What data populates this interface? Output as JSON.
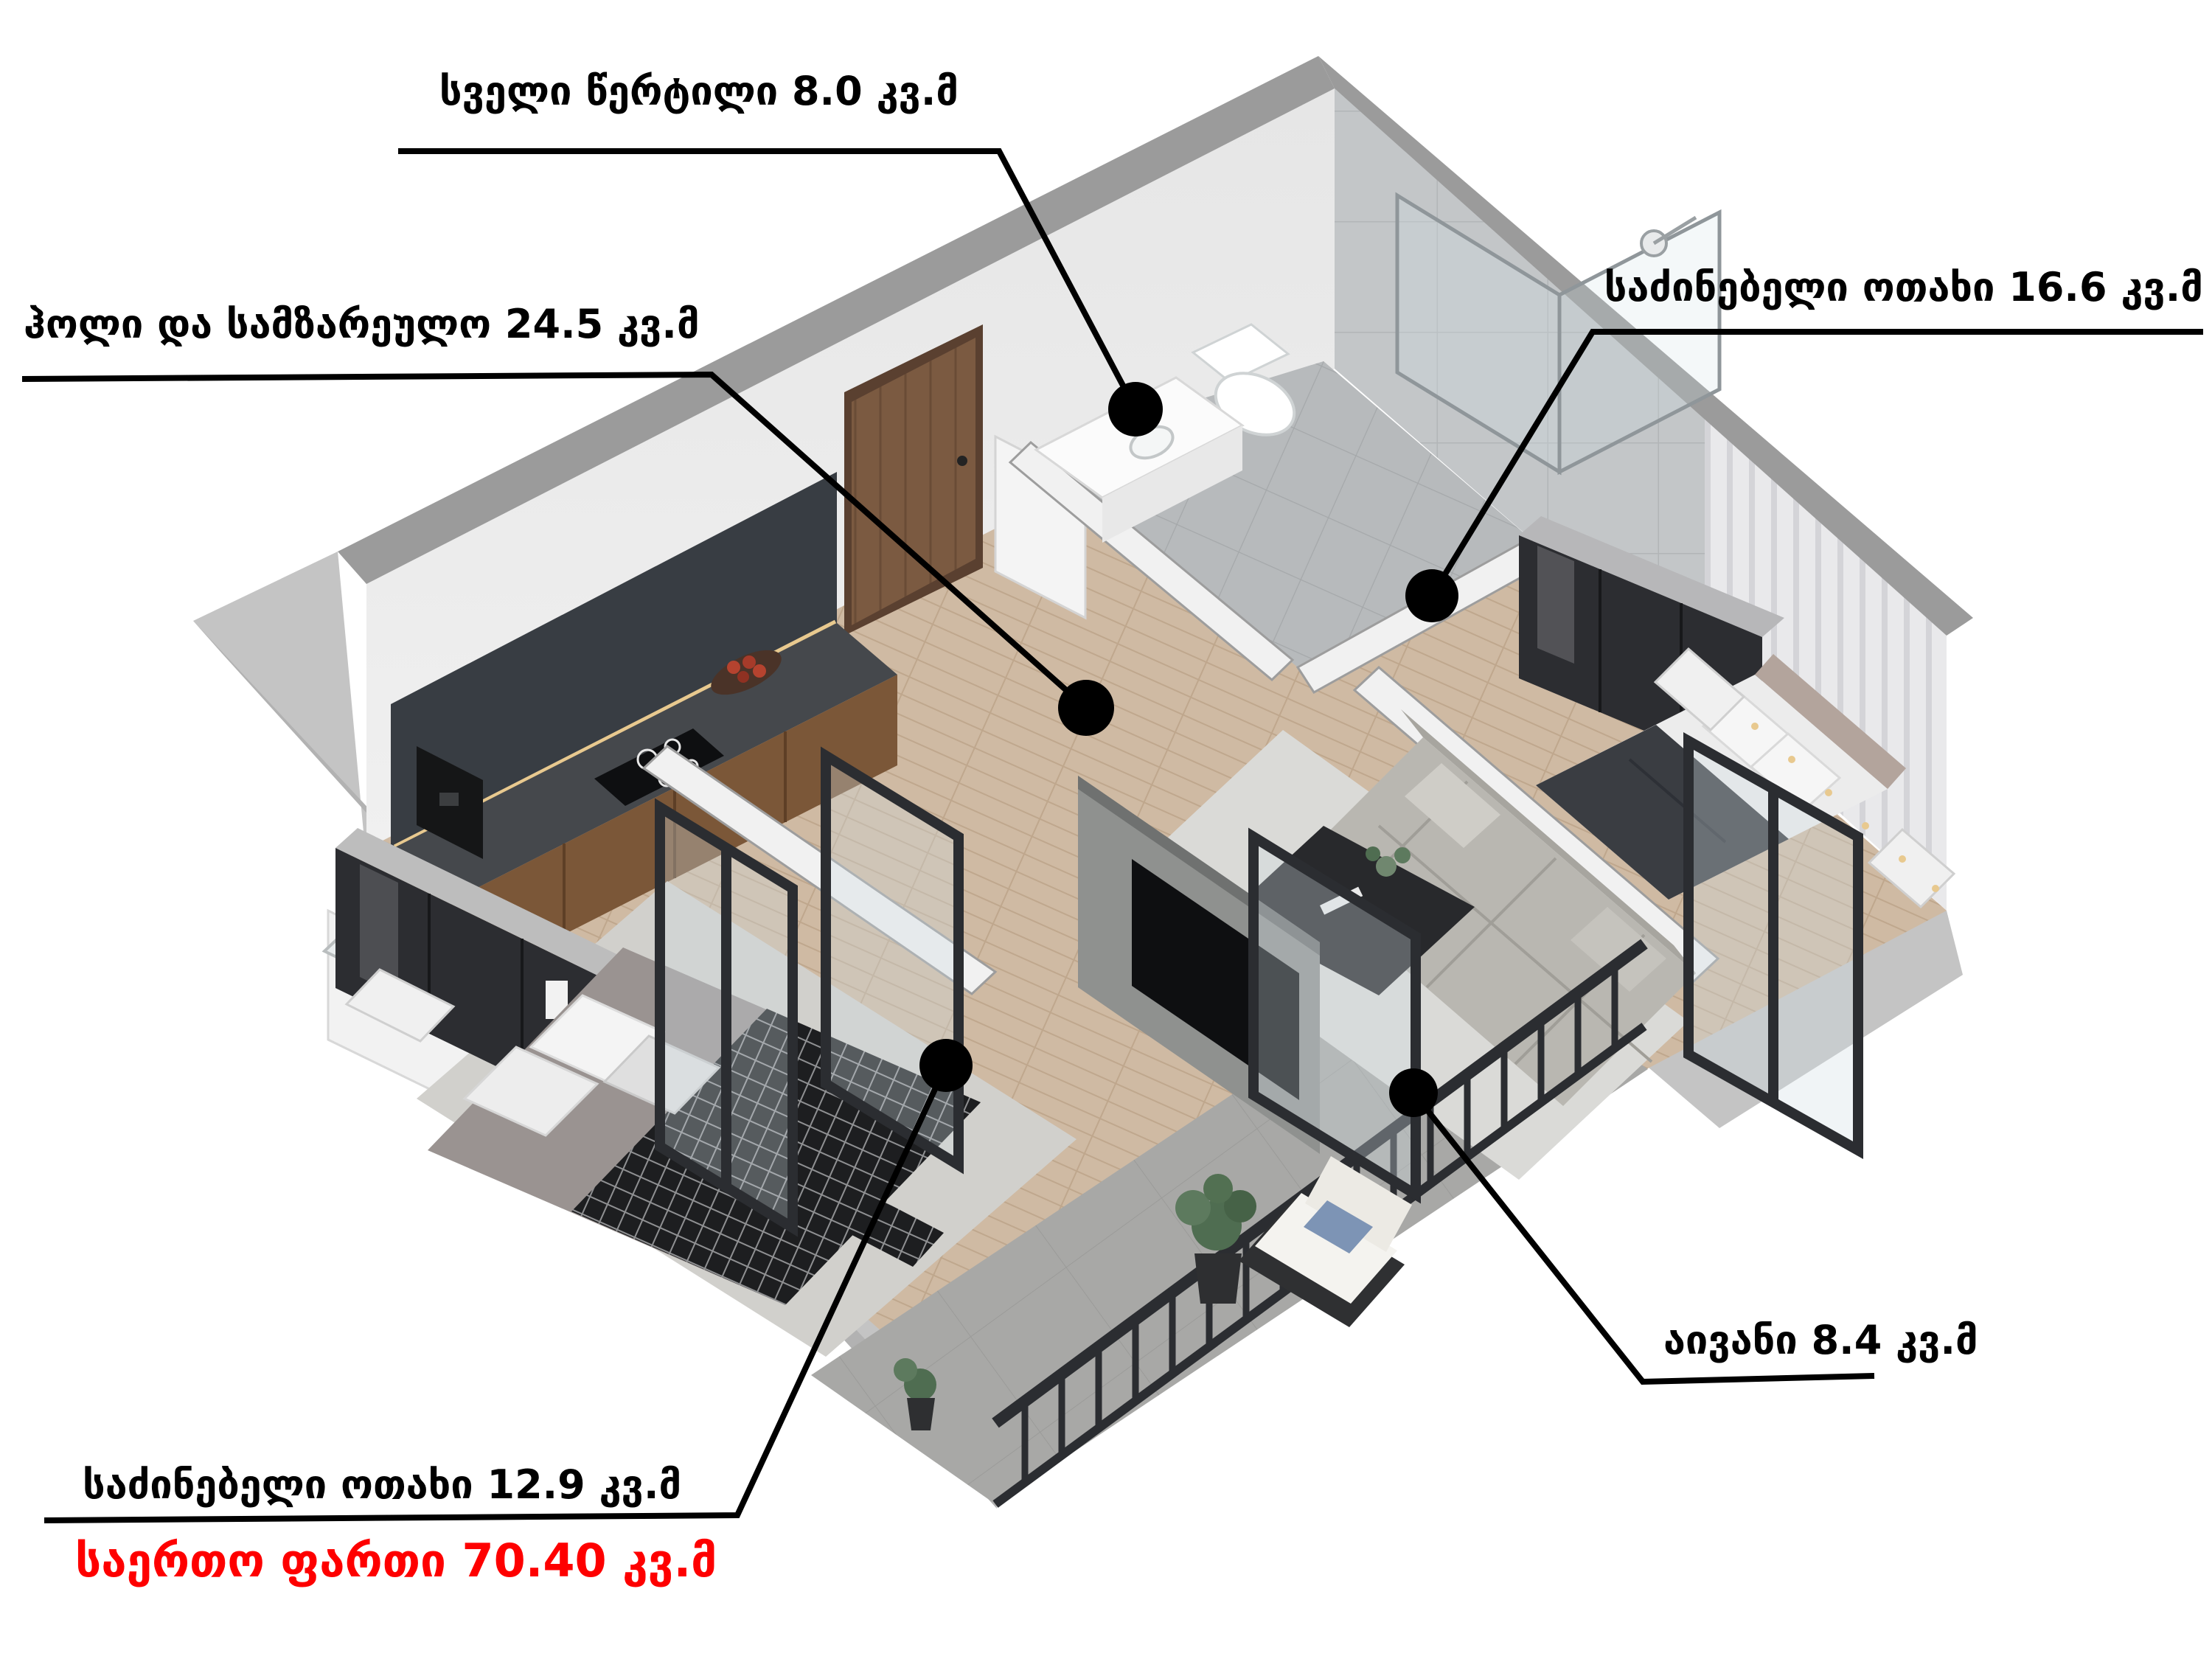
{
  "page": {
    "type": "3d-floor-plan-render",
    "background": "#ffffff",
    "language": "Georgian"
  },
  "units_label": "კვ.მ",
  "rooms": [
    {
      "id": "wet-point",
      "name": "სველი წერტილი",
      "area_sqm": 8.0,
      "label": "სველი წერტილი 8.0 კვ.მ"
    },
    {
      "id": "hall-kitchen",
      "name": "ჰოლი და სამზარეულო",
      "area_sqm": 24.5,
      "label": "ჰოლი და სამზარეულო 24.5 კვ.მ"
    },
    {
      "id": "bedroom-1",
      "name": "საძინებელი ოთახი",
      "area_sqm": 16.6,
      "label": "საძინებელი ოთახი 16.6 კვ.მ"
    },
    {
      "id": "balcony",
      "name": "აივანი",
      "area_sqm": 8.4,
      "label": "აივანი 8.4 კვ.მ"
    },
    {
      "id": "bedroom-2",
      "name": "საძინებელი ოთახი",
      "area_sqm": 12.9,
      "label": "საძინებელი ოთახი 12.9 კვ.მ"
    }
  ],
  "total": {
    "name": "საერთო ფართი",
    "area_sqm": 70.4,
    "label": "საერთო ფართი 70.40 კვ.მ",
    "color": "#fe0000"
  },
  "palette": {
    "red": "#fe0000",
    "black": "#000000",
    "white": "#ffffff",
    "wall_cap": "#9b9b9b",
    "wall_face": "#f0f0f0",
    "wall_face2": "#e6e6e6",
    "concrete": "#c4c4c4",
    "concrete_dark": "#b2b2b2",
    "wood_floor": "#cfbaa3",
    "wood_line": "#bfa78d",
    "tile": "#b7babc",
    "tile_line": "#a5a8aa",
    "stone": "#a8a8a6",
    "stone_dark": "#9b9b99",
    "rug": "#dadad7",
    "rug2": "#d1d0cc",
    "sofa": "#b9b7b1",
    "sofa_dark": "#a7a59f",
    "counter_dark": "#45484c",
    "cabinet_wood": "#7b5738",
    "marble_dark": "#383d43",
    "furn_dark": "#2c2d31",
    "tv_black": "#0e0f11",
    "blanket_dark": "#3a3d42",
    "plaid_dark": "#1d1e20",
    "headboard": "#b3a49c",
    "door_wood": "#7b5a41",
    "frame_black": "#2b2d31",
    "glass": "#cfdde3",
    "plant": "#4f6d51",
    "led": "#e8c98f"
  }
}
